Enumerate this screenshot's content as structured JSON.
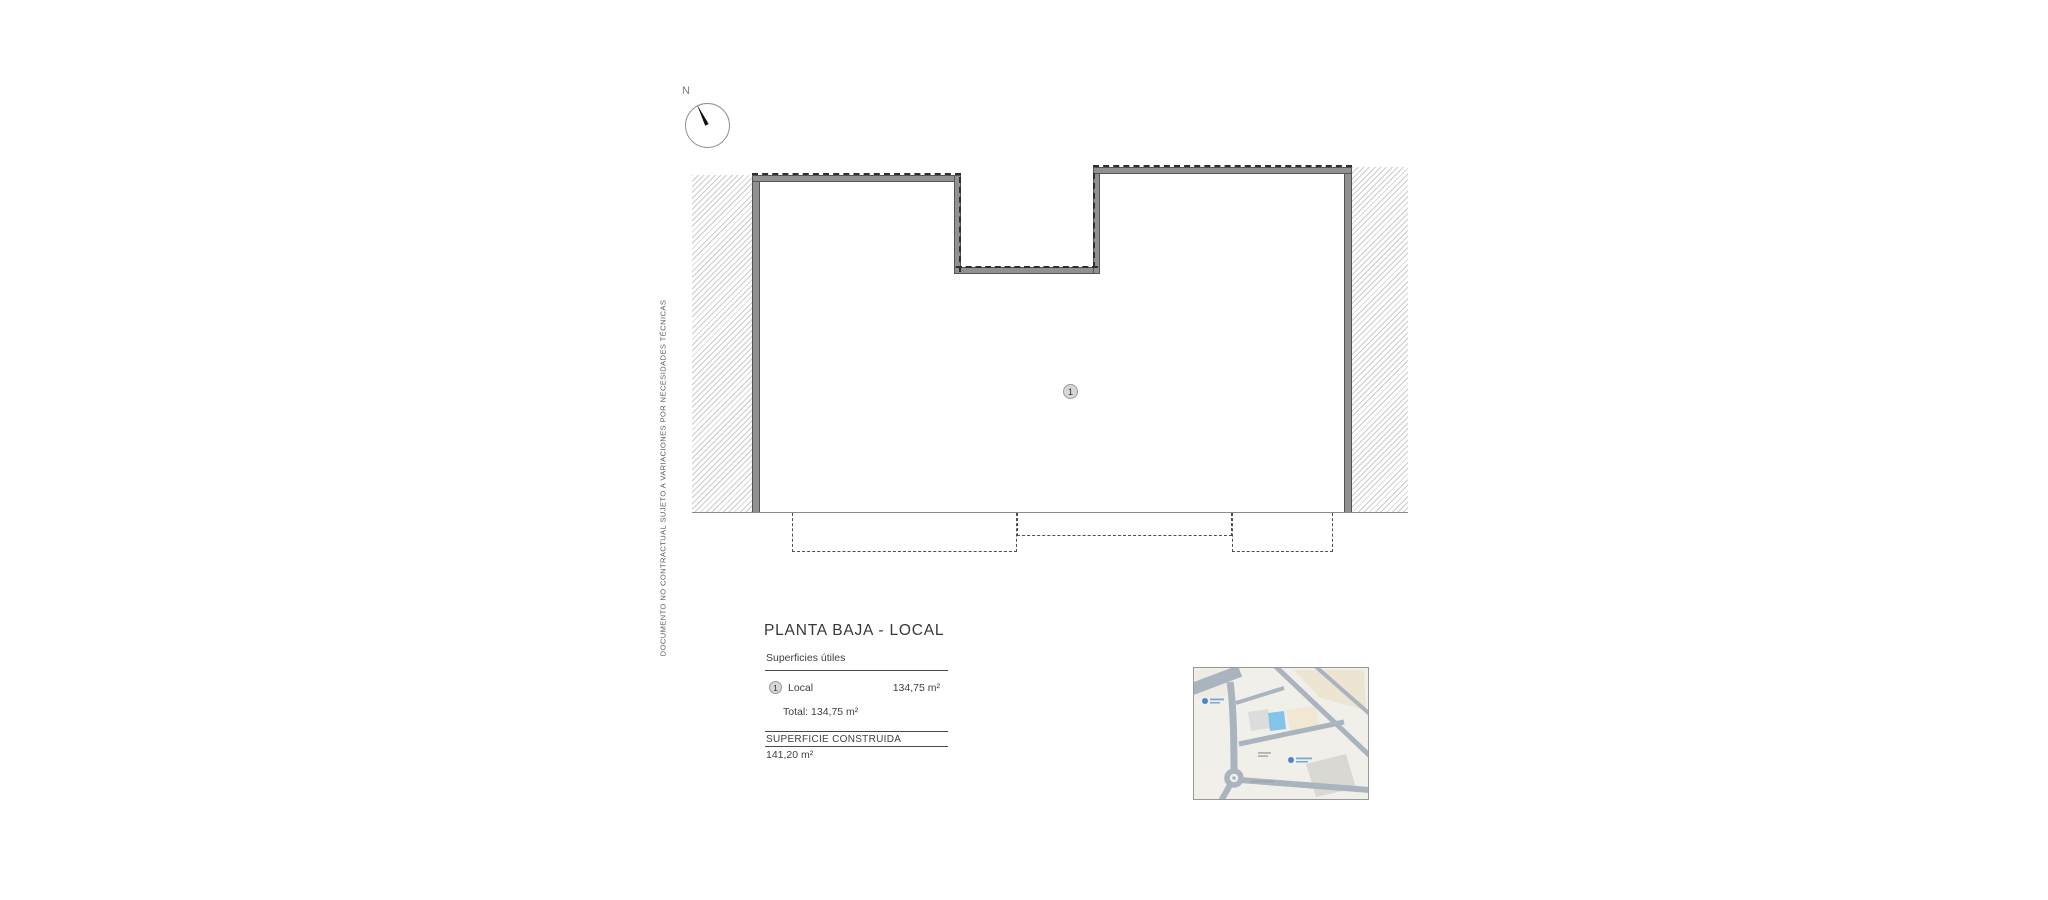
{
  "compass": {
    "label": "N"
  },
  "disclaimer": "DOCUMENTO NO CONTRACTUAL SUJETO A VARIACIONES POR NECESIDADES TÉCNICAS",
  "plan": {
    "unit_badge": "1"
  },
  "legend": {
    "title": "PLANTA BAJA - LOCAL",
    "subtitle": "Superficies útiles",
    "rows": [
      {
        "badge": "1",
        "label": "Local",
        "value": "134,75 m²"
      }
    ],
    "total": "Total: 134,75 m²",
    "constructed_label": "SUPERFICIE CONSTRUIDA",
    "constructed_value": "141,20 m²"
  },
  "colors": {
    "wall_fill": "#919191",
    "wall_edge": "#545454",
    "hatch_line": "#cbcbcb",
    "dashed_line": "#2e2e2e",
    "map_background": "#f1efe9",
    "map_road": "#a9b4bf",
    "parcel_highlight": "#85c4e9",
    "poi_blue": "#4c86c6"
  }
}
